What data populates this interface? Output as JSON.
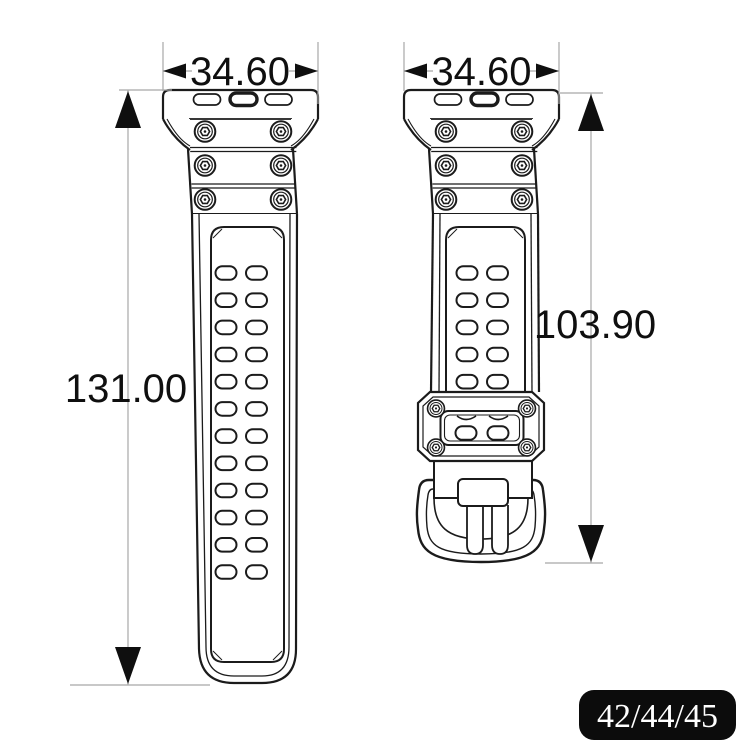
{
  "diagram": {
    "left_view": {
      "width_label": "34.60",
      "length_label": "131.00"
    },
    "right_view": {
      "width_label": "34.60",
      "length_label": "103.90"
    },
    "badge": {
      "sizes_label": "42/44/45"
    },
    "colors": {
      "outline": "#1b1b1b",
      "dimension_lines": "#a8a8a8",
      "dimension_text": "#0f0f0f",
      "badge_background": "#0c0c0c",
      "badge_text": "#ffffff",
      "background": "#ffffff"
    }
  }
}
